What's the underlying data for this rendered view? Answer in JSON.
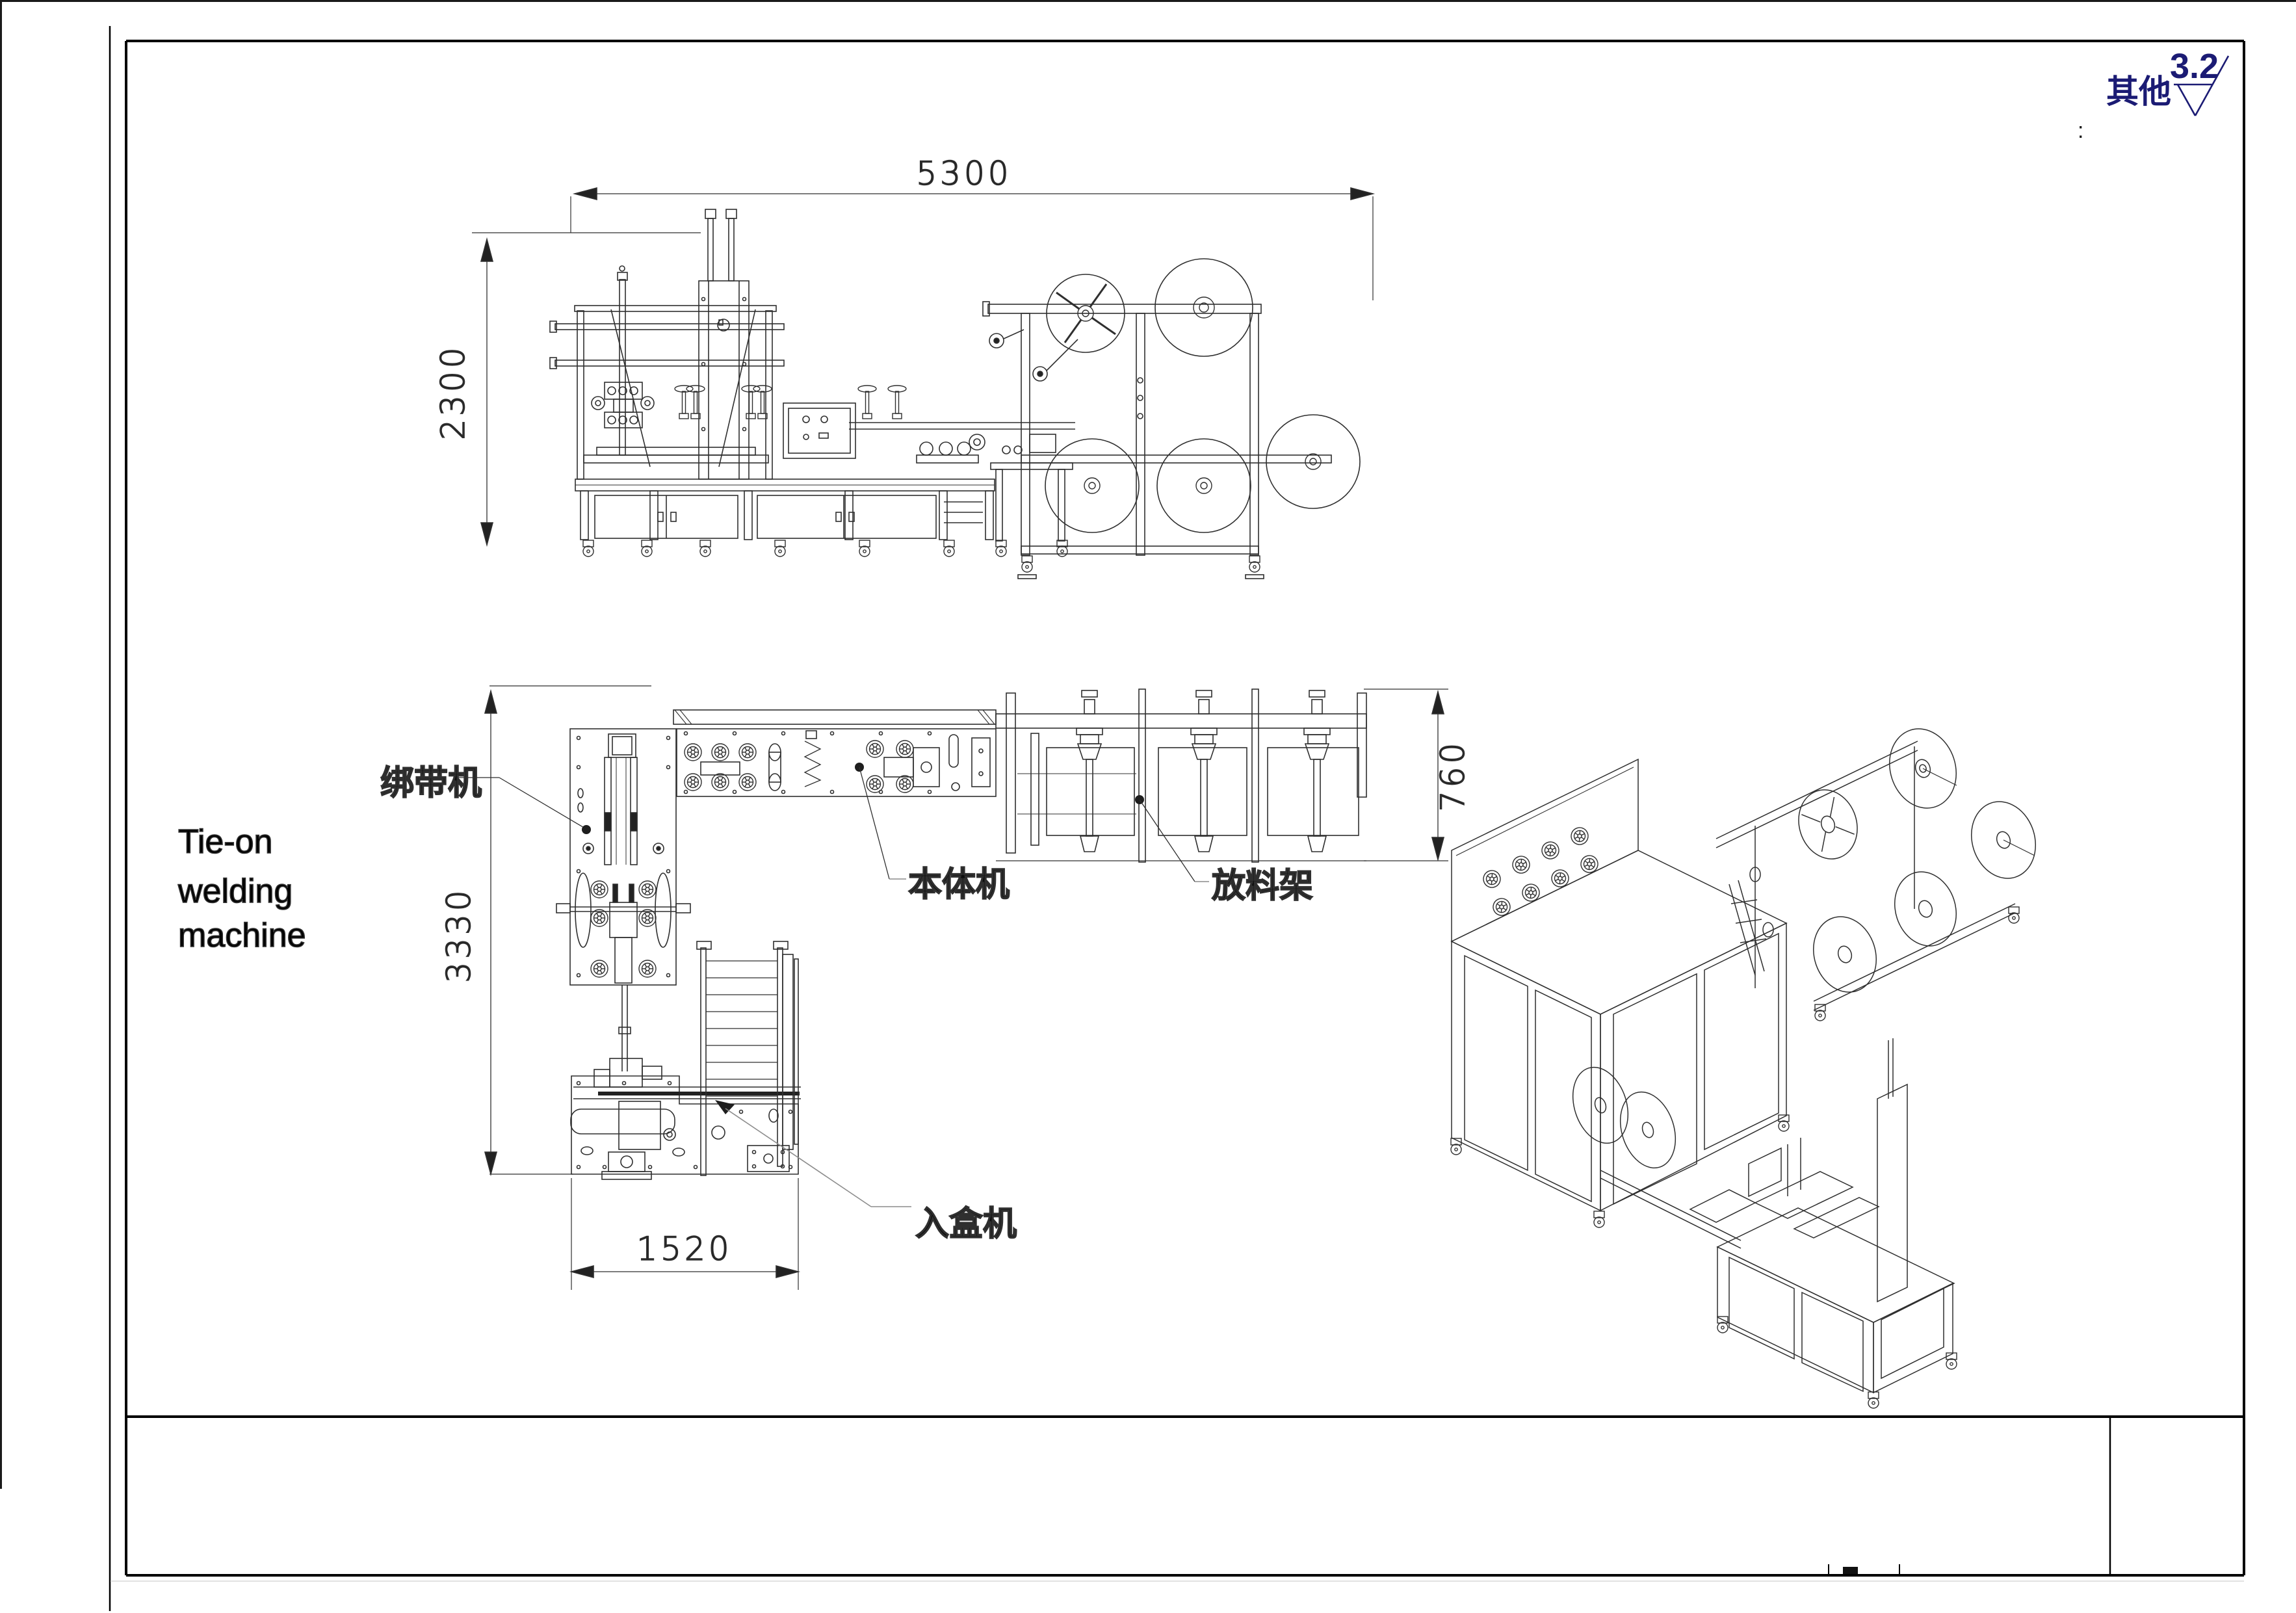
{
  "surface_finish": {
    "scope_label": "其他",
    "roughness_value": "3.2",
    "colon": ":"
  },
  "dimensions": {
    "overall_width": "5300",
    "overall_height": "2300",
    "layout_depth": "3330",
    "rack_depth": "760",
    "box_machine_width": "1520"
  },
  "labels": {
    "strap_machine": "绑带机",
    "tie_on": [
      "Tie-on",
      "welding",
      "machine"
    ],
    "main_body_machine": "本体机",
    "material_rack": "放料架",
    "box_inserting_machine": "入盒机"
  },
  "colors": {
    "line": "#2f2f2f",
    "navy": "#1b1b74",
    "leader": "#8c8c8c",
    "background": "#ffffff"
  }
}
